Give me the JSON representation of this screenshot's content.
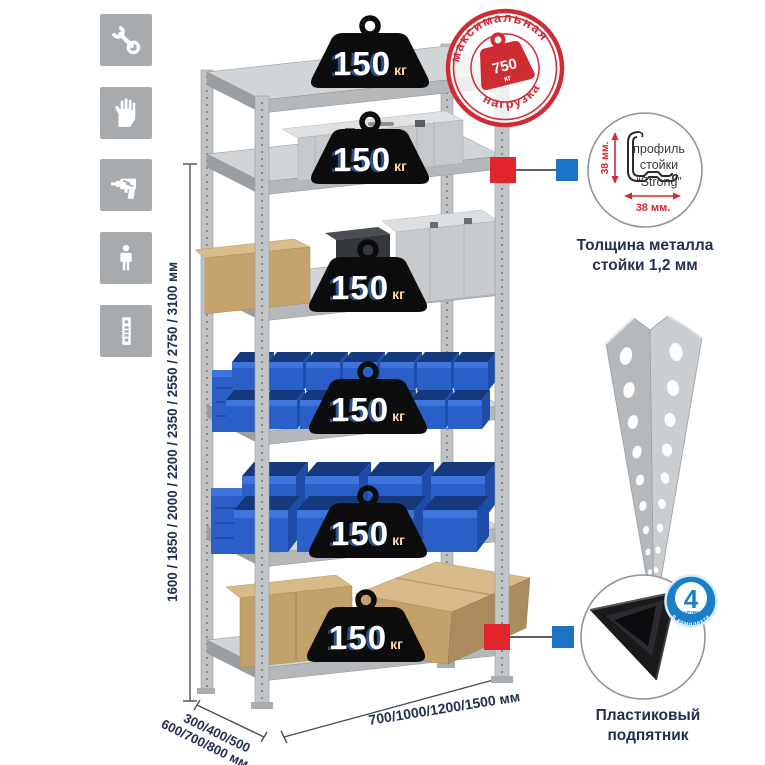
{
  "icons_panel": {
    "items": [
      {
        "icon": "wrench-icon"
      },
      {
        "icon": "gloves-icon"
      },
      {
        "icon": "drill-icon"
      },
      {
        "icon": "person-icon"
      },
      {
        "icon": "perforated-post-icon"
      }
    ]
  },
  "stamp": {
    "arc_top": "максимальная",
    "arc_bottom": "нагрузка",
    "value": "750",
    "unit": "кг"
  },
  "rack": {
    "shelf_count": 6,
    "badge": {
      "value": "150",
      "unit": "кг"
    }
  },
  "dimensions": {
    "height": "1600 / 1850 / 2000 / 2200 / 2350 / 2550 / 2750 / 3100 мм",
    "depth_line1": "300/400/500",
    "depth_line2": "600/700/800 мм",
    "width": "700/1000/1200/1500 мм"
  },
  "profile_detail": {
    "label_line1": "профиль",
    "label_line2": "стойки",
    "label_line3": "“Strong”",
    "dim_vertical": "38 мм.",
    "dim_horizontal": "38 мм.",
    "caption_line1": "Толщина металла",
    "caption_line2": "стойки 1,2 мм"
  },
  "foot_detail": {
    "badge_number": "4",
    "badge_sub": "штуки",
    "badge_arc": "в комплекте",
    "caption_line1": "Пластиковый",
    "caption_line2": "подпятник"
  },
  "colors": {
    "stamp_red": "#cf2b33",
    "marker_red": "#e2242b",
    "marker_blue": "#1b73c6",
    "navy_text": "#223050",
    "bin_blue": "#2a5fc8",
    "badge_blue": "#1b7ec8",
    "icon_gray": "#a8abad"
  }
}
